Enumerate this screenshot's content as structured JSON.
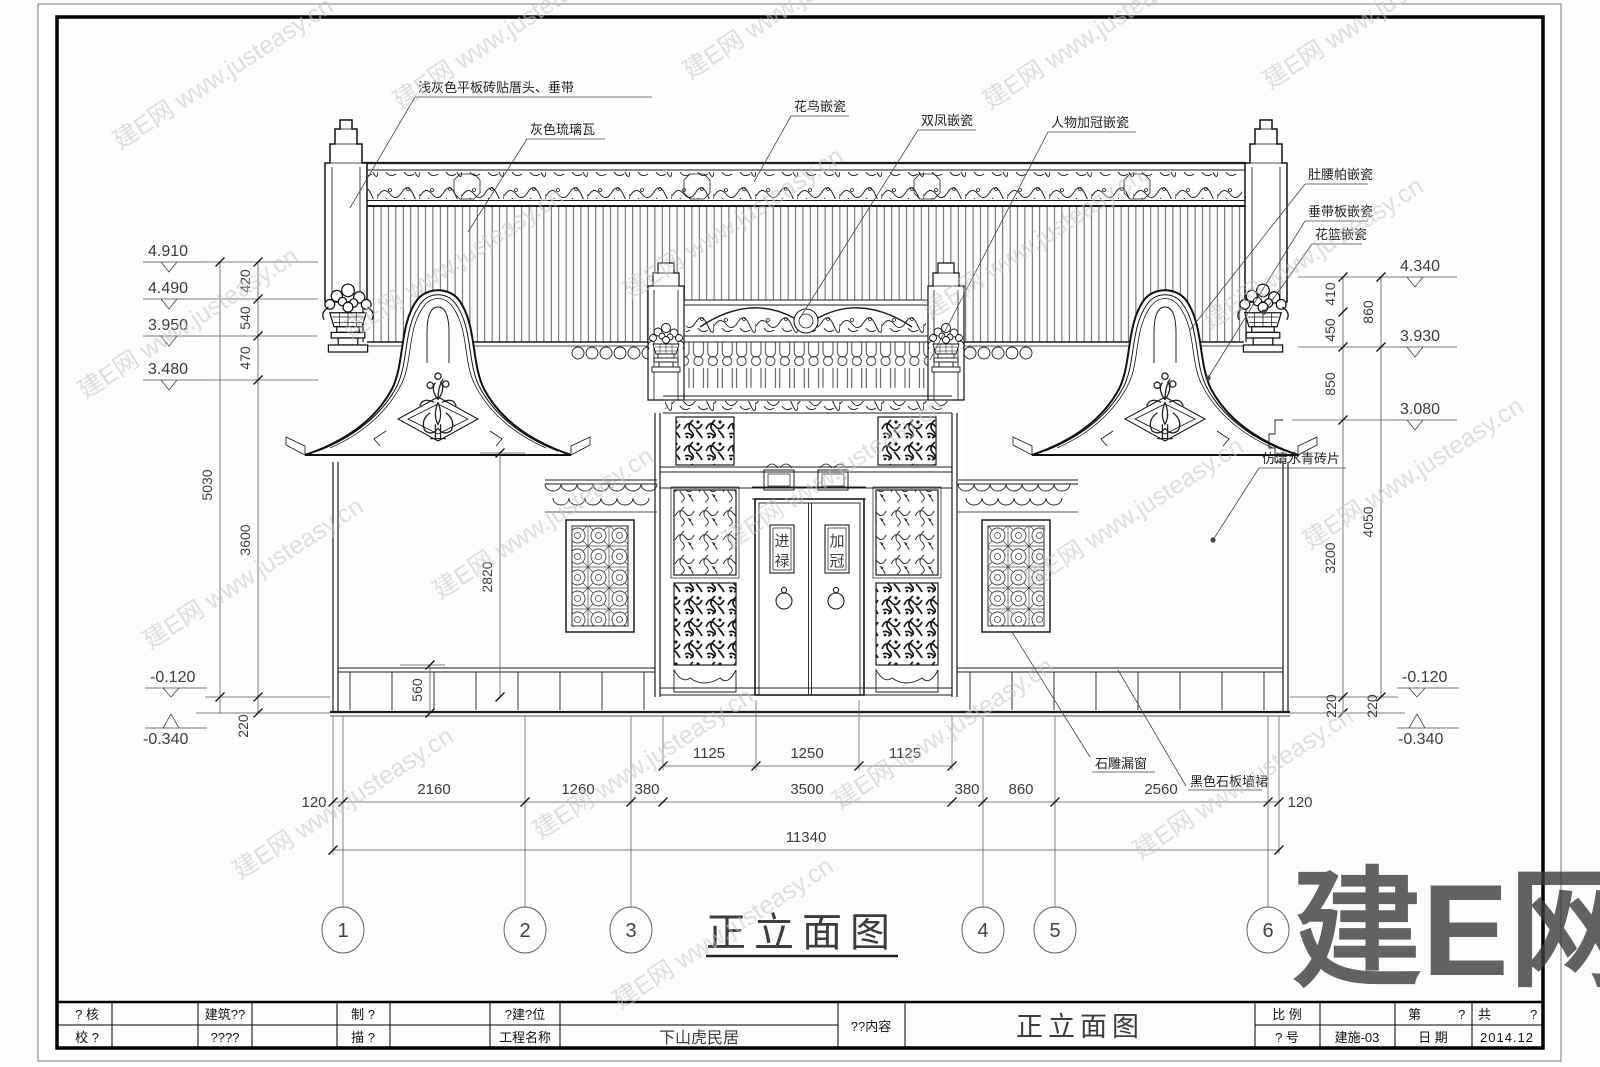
{
  "sheet": {
    "big_watermark": "建E网",
    "watermark": "建E网 www.justeasy.cn"
  },
  "title": {
    "text": "正立面图"
  },
  "axes": {
    "bubbles": [
      "1",
      "2",
      "3",
      "4",
      "5",
      "6"
    ]
  },
  "levels": {
    "left": [
      "4.910",
      "4.490",
      "3.950",
      "3.480",
      "-0.120",
      "-0.340"
    ],
    "right": [
      "4.340",
      "3.930",
      "3.080",
      "-0.120",
      "-0.340"
    ]
  },
  "dims": {
    "left_seg": [
      "420",
      "540",
      "470",
      "3600",
      "220"
    ],
    "left_total": "5030",
    "wall_height": "2820",
    "wainscot": "560",
    "right_seg": [
      "410",
      "450",
      "850",
      "3200",
      "220",
      "220"
    ],
    "right_outer": [
      "860",
      "4050"
    ],
    "door_sub": [
      "1125",
      "1250",
      "1125"
    ],
    "main": [
      "120",
      "2160",
      "1260",
      "380",
      "3500",
      "380",
      "860",
      "2560",
      "120"
    ],
    "total": "11340"
  },
  "annotations": {
    "top": [
      "浅灰色平板砖贴厝头、垂带",
      "灰色琉璃瓦",
      "花鸟嵌瓷",
      "双凤嵌瓷",
      "人物加冠嵌瓷"
    ],
    "right": [
      "肚腰帕嵌瓷",
      "垂带板嵌瓷",
      "花篮嵌瓷",
      "仿清水青砖片"
    ],
    "bottom": [
      "石雕漏窗",
      "黑色石板墙裙"
    ]
  },
  "door_plaques": {
    "left": [
      "进",
      "禄"
    ],
    "right": [
      "加",
      "冠"
    ]
  },
  "titleblock": {
    "row1": {
      "c1": "? 核",
      "c2": "建筑??",
      "c3": "制  ?",
      "c4": "?建?位",
      "scale_label": "比 例",
      "sheet_label": "第",
      "sheet_val": "?",
      "total_label": "共",
      "total_val": "?"
    },
    "row2": {
      "c1": "校 ?",
      "c2": "????",
      "c3": "描  ?",
      "c4": "工程名称",
      "project": "下山虎民居",
      "no_label": "? 号",
      "no_val": "建施-03",
      "date_label": "日 期",
      "date_val": "2014.12"
    },
    "content_label": "??内容",
    "drawing_title": "正立面图"
  }
}
